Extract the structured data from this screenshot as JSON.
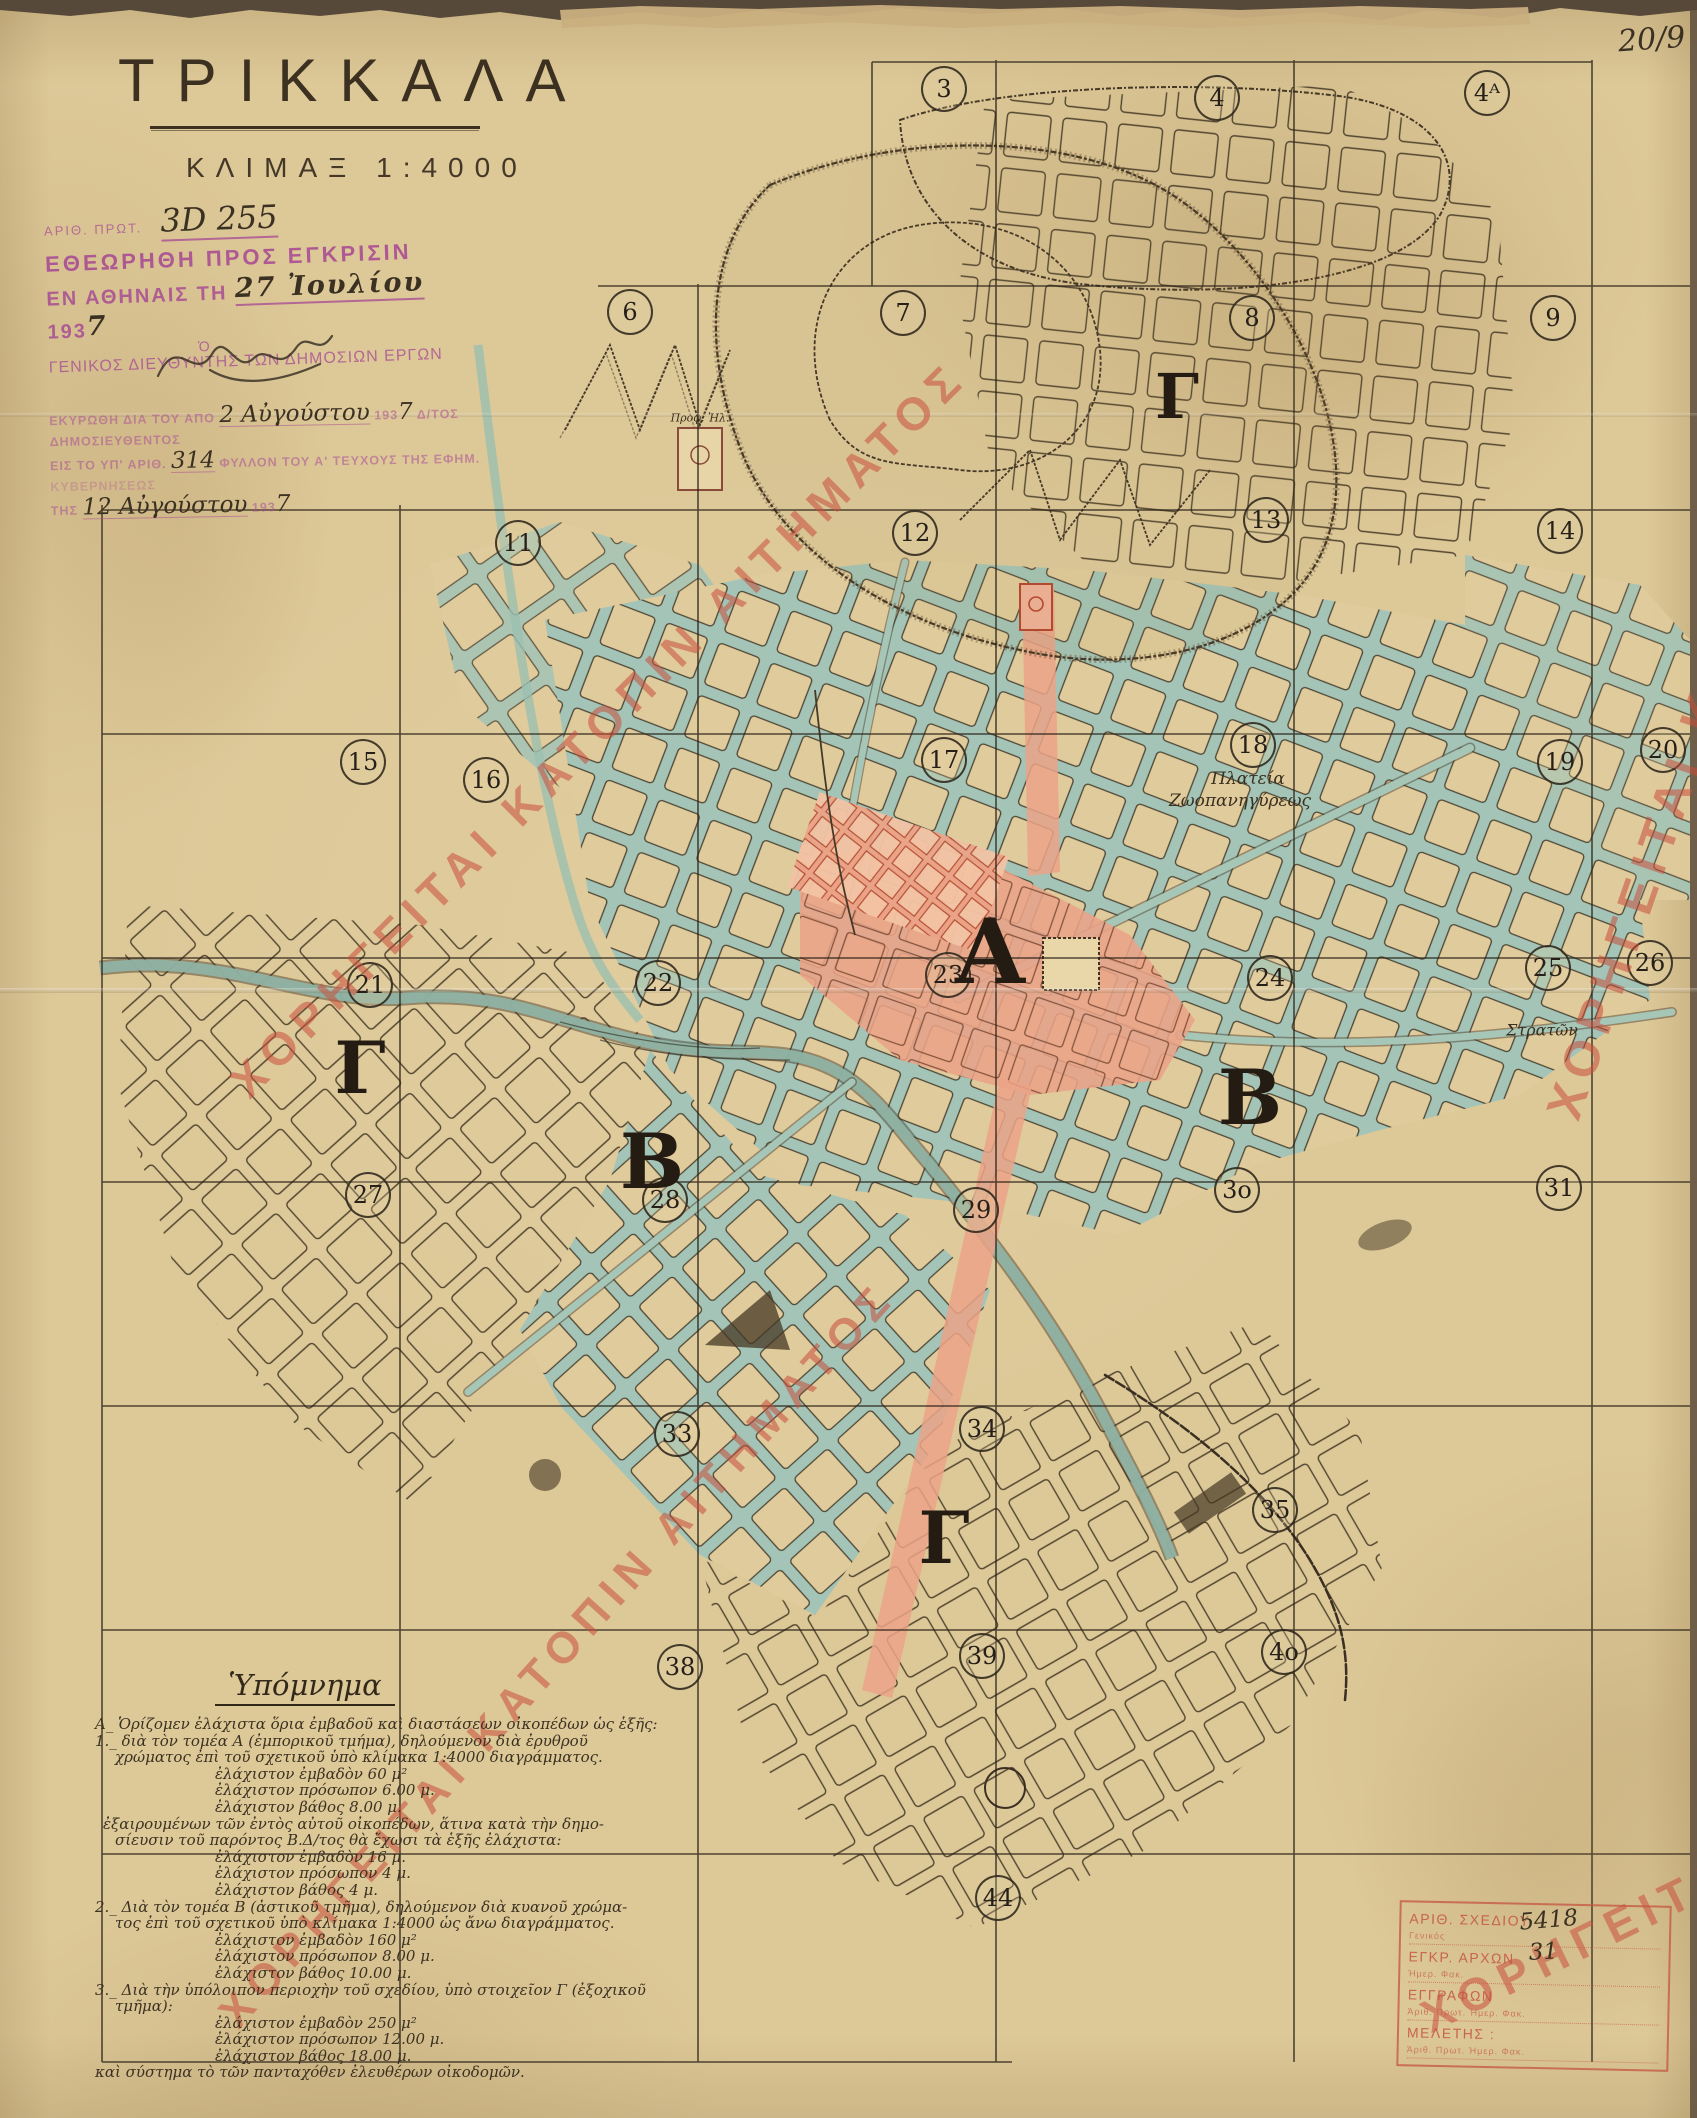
{
  "meta": {
    "sheet_note": "20/9"
  },
  "title": {
    "name": "ΤΡΙΚΚΑΛΑ",
    "scale": "ΚΛΙΜΑΞ  1:4000"
  },
  "stamps": {
    "approval": {
      "protocol_label": "ΑΡΙΘ. ΠΡΩΤ.",
      "protocol_value": "3D 255",
      "line1": "ΕΘΕΩΡΗΘΗ ΠΡΟΣ ΕΓΚΡΙΣΙΝ",
      "place_prefix": "ΕΝ ΑΘΗΝΑΙΣ ΤΗ",
      "date_hand": "27 Ἰουλίου",
      "year_print": "193",
      "year_hand": "7",
      "article": "Ὁ",
      "signer_title": "ΓΕΝΙΚΟΣ ΔΙΕΥΘΥΝΤΗΣ ΤΩΝ ΔΗΜΟΣΙΩΝ ΕΡΓΩΝ"
    },
    "ratification": {
      "l1a": "ΕΚΥΡΩΘΗ ΔΙΑ ΤΟΥ ΑΠΟ",
      "l1_hand": "2 Αὐγούστου",
      "l1b": "193",
      "l1_hand2": "7",
      "l1c": "Δ/ΤΟΣ ΔΗΜΟΣΙΕΥΘΕΝΤΟΣ",
      "l2a": "ΕΙΣ ΤΟ ΥΠ' ΑΡΙΘ.",
      "l2_hand": "314",
      "l2b": "ΦΥΛΛΟΝ ΤΟΥ Α' ΤΕΥΧΟΥΣ ΤΗΣ ΕΦΗΜ.",
      "l3": "ΚΥΒΕΡΝΗΣΕΩΣ",
      "l4a": "ΤΗΣ",
      "l4_hand": "12 Αὐγούστου",
      "l4b": "193",
      "l4_hand2": "7"
    },
    "registry": {
      "rows": [
        {
          "label": "ΑΡΙΘ. ΣΧΕΔΙΟΥ",
          "small": "Γενικός"
        },
        {
          "label": "ΕΓΚΡ. ΑΡΧΩΝ",
          "small": "Ἡμερ.        Φακ."
        },
        {
          "label": "ΕΓΓΡΑΦΩΝ",
          "small": "Ἀριθ. Πρωτ.     Ἡμερ.     Φακ."
        },
        {
          "label": "ΜΕΛΕΤΗΣ :",
          "small": "Ἀριθ. Πρωτ.     Ἡμερ.     Φακ."
        }
      ],
      "hand_values": [
        {
          "text": "5418",
          "x": 118,
          "y": 2,
          "rot": -6
        },
        {
          "text": "31",
          "x": 128,
          "y": 34,
          "rot": -4
        }
      ]
    }
  },
  "watermark": {
    "text": "ΧΟΡΗΓΕΙΤΑΙ ΚΑΤΟΠΙΝ ΑΙΤΗΜΑΤΟΣ",
    "color": "#c94f3d",
    "instances": [
      {
        "x": 238,
        "y": 1062,
        "rot": -45,
        "size": 46
      },
      {
        "x": 228,
        "y": 1996,
        "rot": -48,
        "size": 44
      },
      {
        "x": 1562,
        "y": 1088,
        "rot": -71,
        "size": 50
      },
      {
        "x": 1424,
        "y": 1992,
        "rot": -26,
        "size": 46
      }
    ]
  },
  "map": {
    "grid_numbers": [
      {
        "label": "3",
        "x": 944,
        "y": 89
      },
      {
        "label": "4",
        "x": 1217,
        "y": 98
      },
      {
        "label": "4ᴬ",
        "x": 1487,
        "y": 93
      },
      {
        "label": "6",
        "x": 630,
        "y": 312
      },
      {
        "label": "7",
        "x": 903,
        "y": 313
      },
      {
        "label": "8",
        "x": 1252,
        "y": 318
      },
      {
        "label": "9",
        "x": 1553,
        "y": 318
      },
      {
        "label": "11",
        "x": 518,
        "y": 543
      },
      {
        "label": "12",
        "x": 915,
        "y": 533
      },
      {
        "label": "13",
        "x": 1266,
        "y": 520
      },
      {
        "label": "14",
        "x": 1560,
        "y": 531
      },
      {
        "label": "15",
        "x": 363,
        "y": 762
      },
      {
        "label": "16",
        "x": 486,
        "y": 780
      },
      {
        "label": "17",
        "x": 944,
        "y": 760
      },
      {
        "label": "18",
        "x": 1253,
        "y": 745
      },
      {
        "label": "19",
        "x": 1560,
        "y": 762
      },
      {
        "label": "20",
        "x": 1663,
        "y": 750
      },
      {
        "label": "21",
        "x": 370,
        "y": 985
      },
      {
        "label": "22",
        "x": 658,
        "y": 983
      },
      {
        "label": "23",
        "x": 948,
        "y": 975
      },
      {
        "label": "24",
        "x": 1270,
        "y": 978
      },
      {
        "label": "25",
        "x": 1548,
        "y": 968
      },
      {
        "label": "26",
        "x": 1650,
        "y": 963
      },
      {
        "label": "27",
        "x": 368,
        "y": 1195
      },
      {
        "label": "28",
        "x": 665,
        "y": 1200
      },
      {
        "label": "29",
        "x": 976,
        "y": 1210
      },
      {
        "label": "3o",
        "x": 1237,
        "y": 1190
      },
      {
        "label": "31",
        "x": 1559,
        "y": 1188
      },
      {
        "label": "33",
        "x": 677,
        "y": 1434
      },
      {
        "label": "34",
        "x": 982,
        "y": 1429
      },
      {
        "label": "35",
        "x": 1275,
        "y": 1510
      },
      {
        "label": "38",
        "x": 680,
        "y": 1667
      },
      {
        "label": "39",
        "x": 982,
        "y": 1656
      },
      {
        "label": "4o",
        "x": 1284,
        "y": 1652
      },
      {
        "label": "44",
        "x": 998,
        "y": 1898
      }
    ],
    "sector_letters": [
      {
        "label": "Γ",
        "x": 1177,
        "y": 397,
        "size": 62
      },
      {
        "label": "Γ",
        "x": 360,
        "y": 1068,
        "size": 72
      },
      {
        "label": "Α",
        "x": 990,
        "y": 952,
        "size": 90
      },
      {
        "label": "Β",
        "x": 1250,
        "y": 1098,
        "size": 76
      },
      {
        "label": "Β",
        "x": 652,
        "y": 1162,
        "size": 76
      },
      {
        "label": "Γ",
        "x": 944,
        "y": 1538,
        "size": 72
      }
    ],
    "labels": [
      {
        "text": "Πλατεία",
        "x": 1248,
        "y": 779,
        "size": 17
      },
      {
        "text": "Ζωοπανηγύρεως",
        "x": 1240,
        "y": 801,
        "size": 17
      },
      {
        "text": "Στρατῶν",
        "x": 1542,
        "y": 1030,
        "size": 16
      },
      {
        "text": "Προφ. Ἠλ.",
        "x": 700,
        "y": 418,
        "size": 11
      }
    ]
  },
  "legend": {
    "heading": "Ὑπόμνημα",
    "lines": [
      {
        "c": "h",
        "t": "Α_  Ὁρίζομεν ἐλάχιστα ὅρια ἐμβαδοῦ καὶ διαστάσεων οἰκοπέδων ὡς ἑξῆς:"
      },
      {
        "c": "h",
        "t": "1._  διὰ τὸν τομέα Α (ἐμπορικοῦ τμήμα), δηλούμενον διὰ ἐρυθροῦ"
      },
      {
        "c": "t",
        "t": "χρώματος ἐπὶ τοῦ σχετικοῦ ὑπὸ κλίμακα 1:4000 διαγράμματος."
      },
      {
        "c": "v",
        "t": "ἐλάχιστον ἐμβαδὸν 60 μ²"
      },
      {
        "c": "v",
        "t": "ἐλάχιστον πρόσωπον 6.00 μ."
      },
      {
        "c": "v",
        "t": "ἐλάχιστον βάθος 8.00 μ."
      },
      {
        "c": "t2",
        "t": "ἐξαιρουμένων τῶν ἐντὸς αὐτοῦ οἰκοπέδων, ἅτινα κατὰ τὴν δημο-"
      },
      {
        "c": "t",
        "t": "σίευσιν τοῦ παρόντος Β.Δ/τος θὰ ἔχωσι τὰ ἑξῆς ἐλάχιστα:"
      },
      {
        "c": "v",
        "t": "ἐλάχιστον ἐμβαδὸν 16 μ."
      },
      {
        "c": "v",
        "t": "ἐλάχιστον πρόσωπον 4 μ."
      },
      {
        "c": "v",
        "t": "ἐλάχιστον βάθος 4 μ."
      },
      {
        "c": "h",
        "t": "2._  Διὰ τὸν τομέα Β (ἀστικοῦ τμῆμα), δηλούμενον διὰ κυανοῦ χρώμα-"
      },
      {
        "c": "t",
        "t": "τος ἐπὶ τοῦ σχετικοῦ ὑπὸ κλίμακα 1:4000 ὡς ἄνω διαγράμματος."
      },
      {
        "c": "v",
        "t": "ἐλάχιστον ἐμβαδὸν 160 μ²"
      },
      {
        "c": "v",
        "t": "ἐλάχιστον πρόσωπον 8.00 μ."
      },
      {
        "c": "v",
        "t": "ἐλάχιστον βάθος 10.00 μ."
      },
      {
        "c": "h",
        "t": "3._  Διὰ τὴν ὑπόλοιπον περιοχὴν τοῦ σχεδίου, ὑπὸ στοιχεῖον Γ (ἐξοχικοῦ"
      },
      {
        "c": "t",
        "t": "τμῆμα):"
      },
      {
        "c": "v",
        "t": "ἐλάχιστον ἐμβαδὸν 250 μ²"
      },
      {
        "c": "v",
        "t": "ἐλάχιστον πρόσωπον 12.00 μ."
      },
      {
        "c": "v",
        "t": "ἐλάχιστον βάθος 18.00 μ."
      },
      {
        "c": "h",
        "t": "καὶ σύστημα τὸ τῶν πανταχόθεν ἐλευθέρων οἰκοδομῶν."
      }
    ]
  },
  "colors": {
    "paper": "#ddc898",
    "ink": "#2f261c",
    "stamp_purple": "#a94f93",
    "stamp_red": "#c4543f",
    "watermark_red": "#c94f3d",
    "street_blue": "#a3c4b6",
    "zone_pink": "#eba387"
  }
}
